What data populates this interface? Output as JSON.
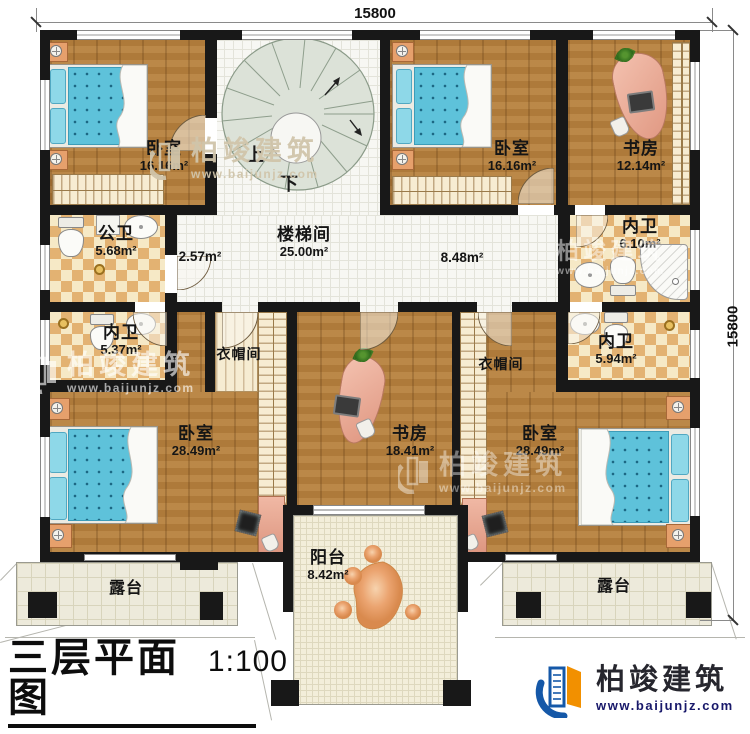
{
  "dimensions": {
    "top": "15800",
    "right": "15800"
  },
  "hall": {
    "stair_name": "楼梯间",
    "stair_area": "25.00m²",
    "left_area": "2.57m²",
    "right_area": "8.48m²",
    "up": "上",
    "down": "下"
  },
  "rooms": {
    "bedroom_tl": {
      "name": "卧室",
      "area": "16.16m²"
    },
    "bedroom_tr": {
      "name": "卧室",
      "area": "16.16m²"
    },
    "study_tr": {
      "name": "书房",
      "area": "12.14m²"
    },
    "ensuite_tr": {
      "name": "内卫",
      "area": "6.10m²"
    },
    "bath_public": {
      "name": "公卫",
      "area": "5.68m²"
    },
    "ensuite_ml": {
      "name": "内卫",
      "area": "5.37m²"
    },
    "ensuite_mr": {
      "name": "内卫",
      "area": "5.94m²"
    },
    "cloak_left": {
      "name": "衣帽间"
    },
    "cloak_right": {
      "name": "衣帽间"
    },
    "study_center": {
      "name": "书房",
      "area": "18.41m²"
    },
    "bedroom_bl": {
      "name": "卧室",
      "area": "28.49m²"
    },
    "bedroom_br": {
      "name": "卧室",
      "area": "28.49m²"
    },
    "balcony": {
      "name": "阳台",
      "area": "8.42m²"
    },
    "terrace_left": {
      "name": "露台"
    },
    "terrace_right": {
      "name": "露台"
    }
  },
  "title_block": {
    "title": "三层平面图",
    "scale": "1:100",
    "area_text": "本层建筑面积：204.05m²",
    "height_text": "层高：3.3m"
  },
  "brand": {
    "name": "柏竣建筑",
    "url": "www.baijunjz.com"
  },
  "watermark": {
    "name": "柏竣建筑",
    "url": "www.baijunjz.com"
  },
  "colors": {
    "wall": "#181818",
    "wood": "#b5813f",
    "tile_dark": "#e3b272",
    "bed": "#5ec2da",
    "desk": "#e8a28e",
    "brand_blue": "#1558a8",
    "brand_orange": "#f29000"
  }
}
